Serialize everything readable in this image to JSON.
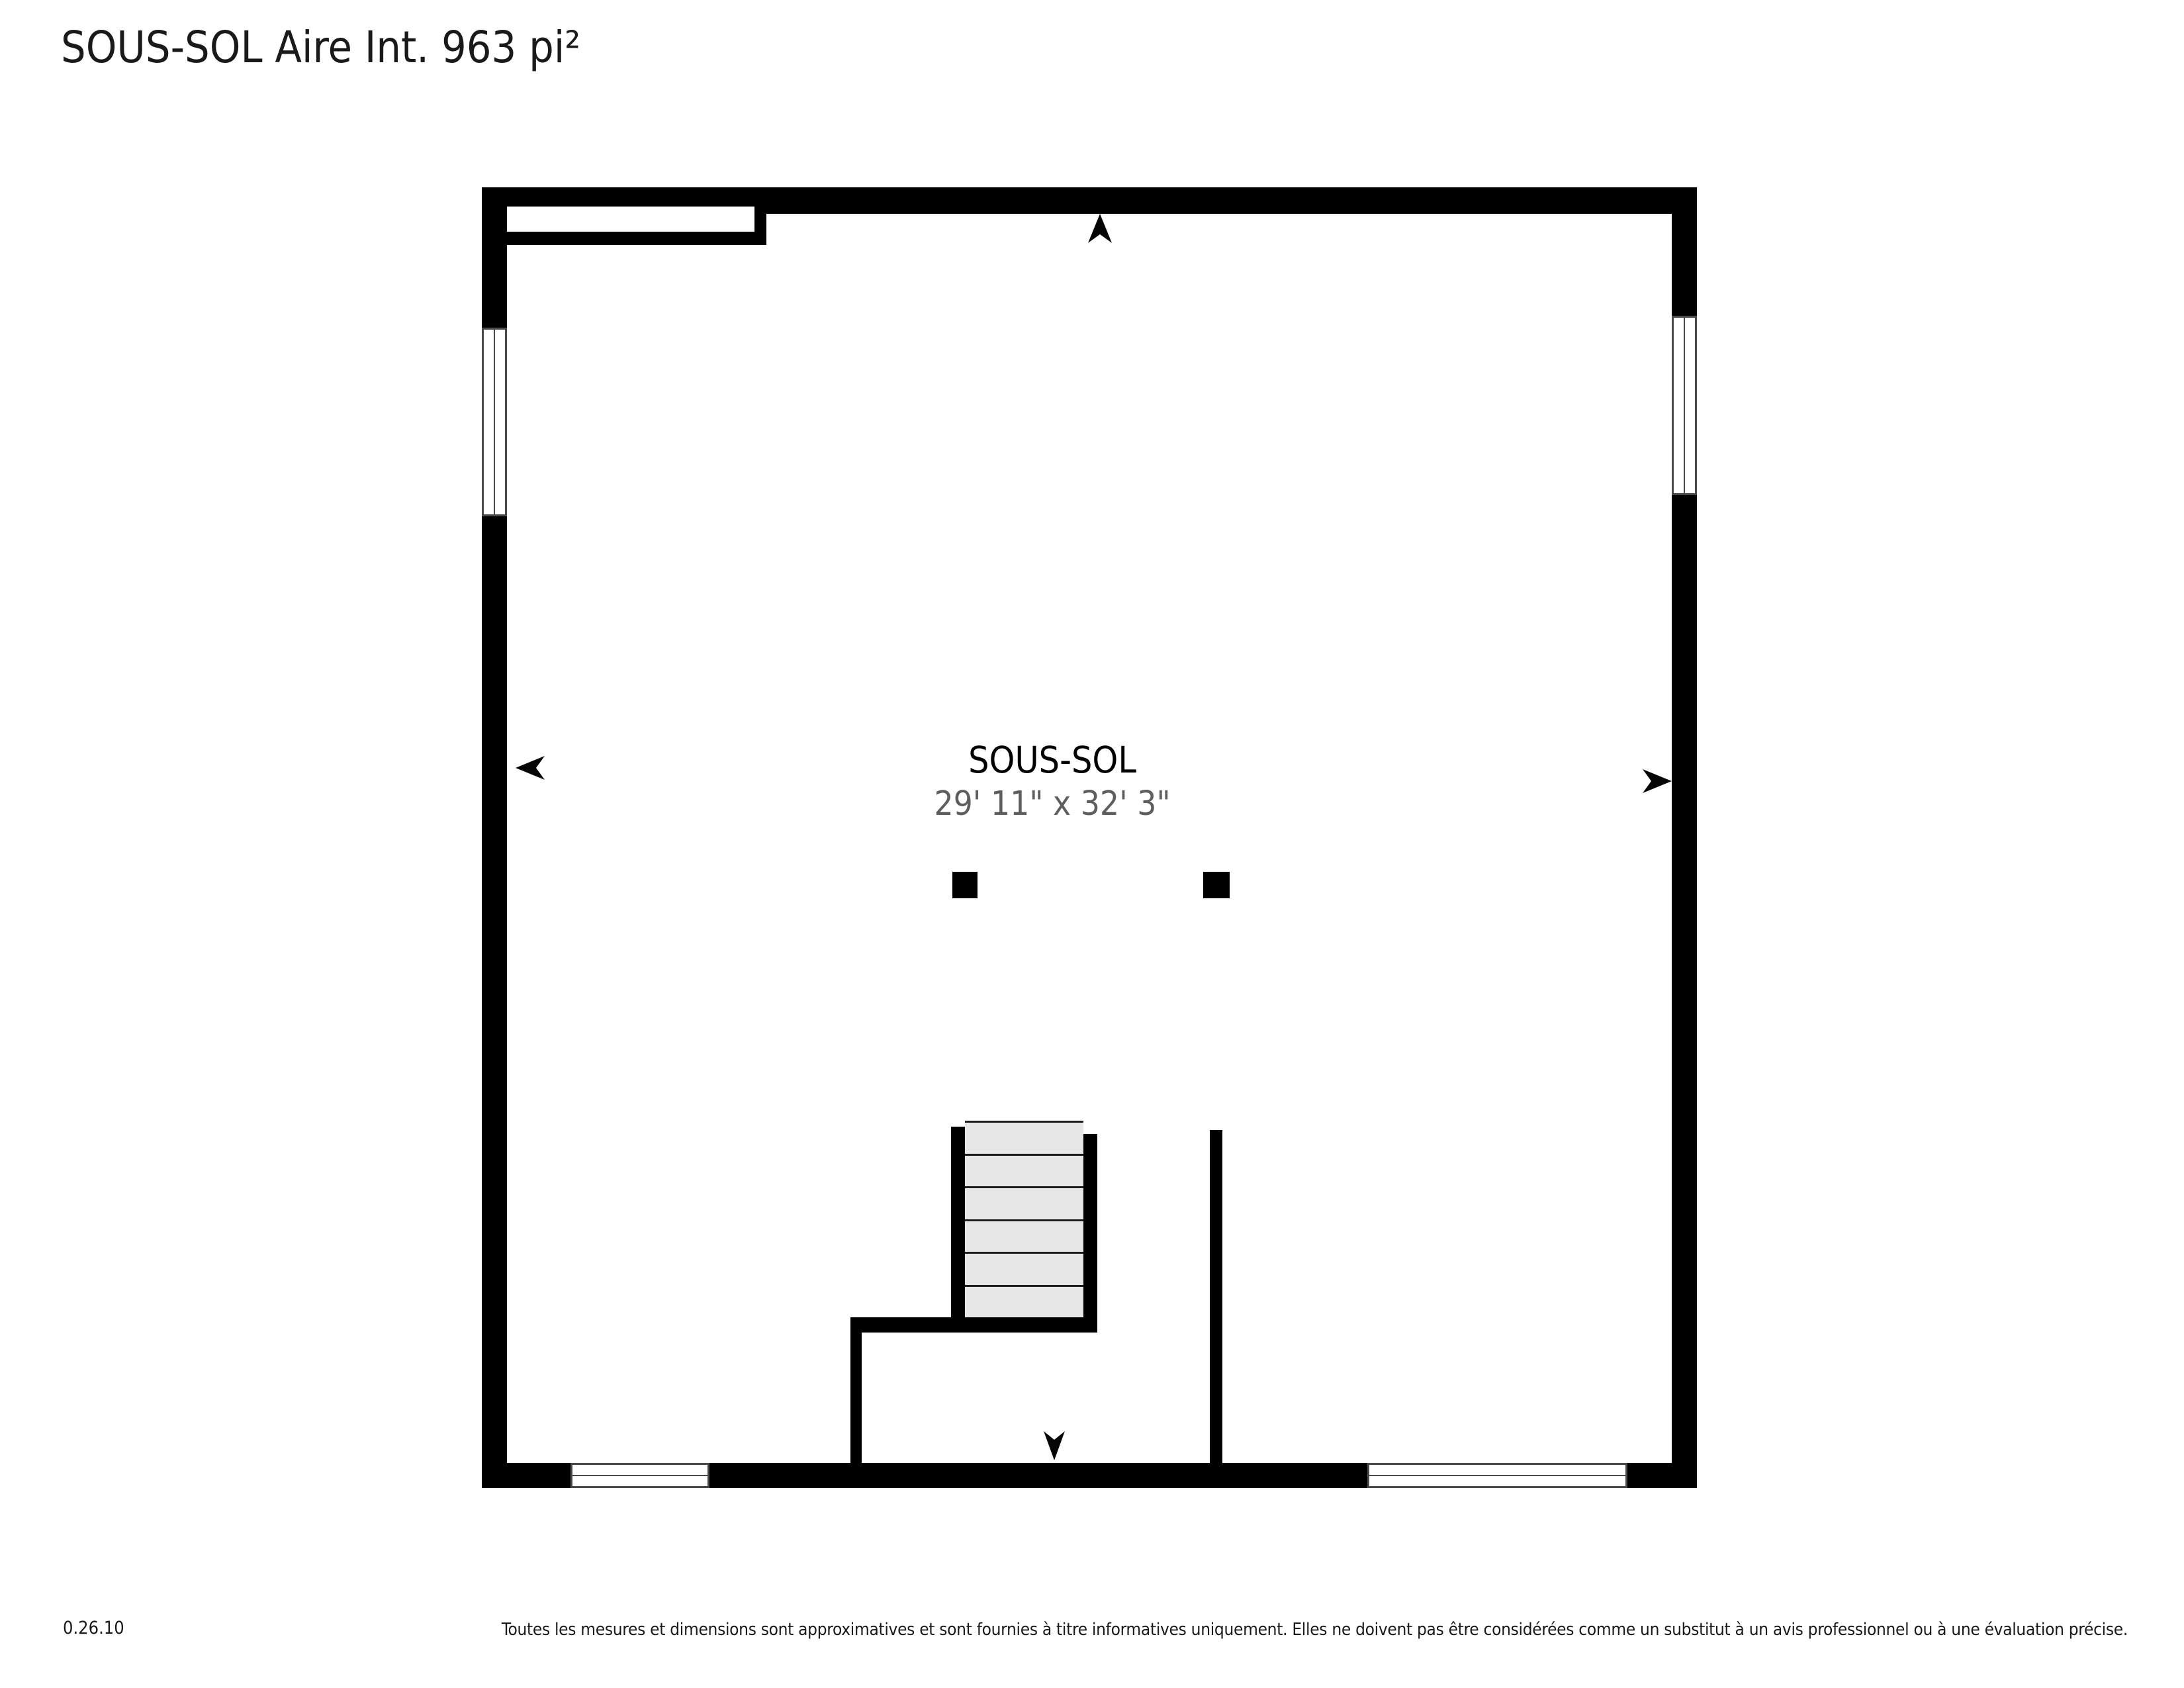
{
  "header": {
    "title": "SOUS-SOL Aire Int. 963 pi²"
  },
  "room": {
    "name": "SOUS-SOL",
    "dimensions": "29' 11\" x 32' 3\""
  },
  "stairs": {
    "step_count": 6
  },
  "icons": {
    "arrows": [
      "arrow-up-icon",
      "arrow-left-icon",
      "arrow-right-icon",
      "arrow-down-icon"
    ]
  },
  "colors": {
    "wall": "#000000",
    "stair_fill": "#e7e7e7",
    "stair_line": "#1c1c1c",
    "window_border": "#4a4a4a",
    "dimension_text": "#5e5e5e",
    "text": "#1a1a1a",
    "background": "#ffffff"
  },
  "footer": {
    "version": "0.26.10",
    "disclaimer": "Toutes les mesures et dimensions sont approximatives et sont fournies à titre informatives uniquement. Elles ne doivent pas être considérées comme un substitut à un avis professionnel ou à une évaluation précise."
  }
}
